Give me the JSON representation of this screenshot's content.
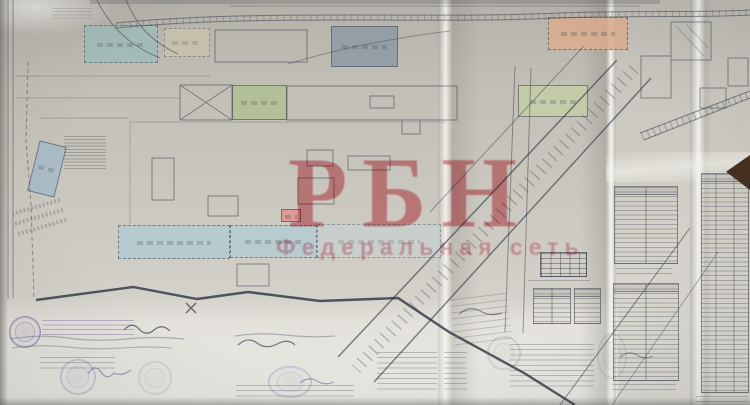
{
  "watermark": {
    "title": "РБН",
    "subtitle": "Федеральная сеть",
    "title_color": "#d43e4a",
    "subtitle_color": "#de687a"
  },
  "paper": {
    "base_color": "#c2bfb6",
    "light_color": "#d8d6cf",
    "ink_color": "#3c4150",
    "stamp_color": "#6754a3",
    "corner_wedge_color": "#45301f"
  },
  "plan": {
    "blocks": [
      {
        "name": "storage-block-teal",
        "x": 84,
        "y": 25,
        "w": 74,
        "h": 38,
        "fill": "#9fbdbb",
        "opacity": 0.8,
        "dashed": true,
        "angle": 0
      },
      {
        "name": "storage-block-cream",
        "x": 164,
        "y": 28,
        "w": 46,
        "h": 29,
        "fill": "#cdc6ac",
        "opacity": 0.6,
        "dashed": true,
        "angle": 0
      },
      {
        "name": "workshop-block-steel",
        "x": 331,
        "y": 26,
        "w": 67,
        "h": 41,
        "fill": "#8a99a6",
        "opacity": 0.8,
        "dashed": false,
        "angle": 0
      },
      {
        "name": "storage-block-orange",
        "x": 548,
        "y": 17,
        "w": 80,
        "h": 33,
        "fill": "#dcae8e",
        "opacity": 0.85,
        "dashed": true,
        "angle": 0
      },
      {
        "name": "garage-block-green",
        "x": 232,
        "y": 85,
        "w": 55,
        "h": 35,
        "fill": "#afc191",
        "opacity": 0.8,
        "dashed": false,
        "angle": 0
      },
      {
        "name": "workshop-block-green",
        "x": 518,
        "y": 85,
        "w": 70,
        "h": 32,
        "fill": "#c4cfa6",
        "opacity": 0.8,
        "dashed": false,
        "angle": 0
      },
      {
        "name": "office-block-blue-tilted",
        "x": 33,
        "y": 143,
        "w": 28,
        "h": 52,
        "fill": "#a4bac9",
        "opacity": 0.8,
        "dashed": false,
        "angle": 14
      },
      {
        "name": "warehouse-band-blue-left",
        "x": 118,
        "y": 225,
        "w": 112,
        "h": 34,
        "fill": "#b3cad3",
        "opacity": 0.85,
        "dashed": true,
        "angle": 0
      },
      {
        "name": "warehouse-band-blue-right",
        "x": 230,
        "y": 225,
        "w": 87,
        "h": 33,
        "fill": "#b5ccd3",
        "opacity": 0.85,
        "dashed": true,
        "angle": 0
      },
      {
        "name": "warehouse-band-pale",
        "x": 317,
        "y": 224,
        "w": 124,
        "h": 34,
        "fill": "#c6d2d2",
        "opacity": 0.6,
        "dashed": true,
        "angle": 0
      },
      {
        "name": "substation-block-pink",
        "x": 281,
        "y": 209,
        "w": 20,
        "h": 13,
        "fill": "#e09694",
        "opacity": 0.9,
        "dashed": false,
        "angle": 0
      }
    ]
  }
}
